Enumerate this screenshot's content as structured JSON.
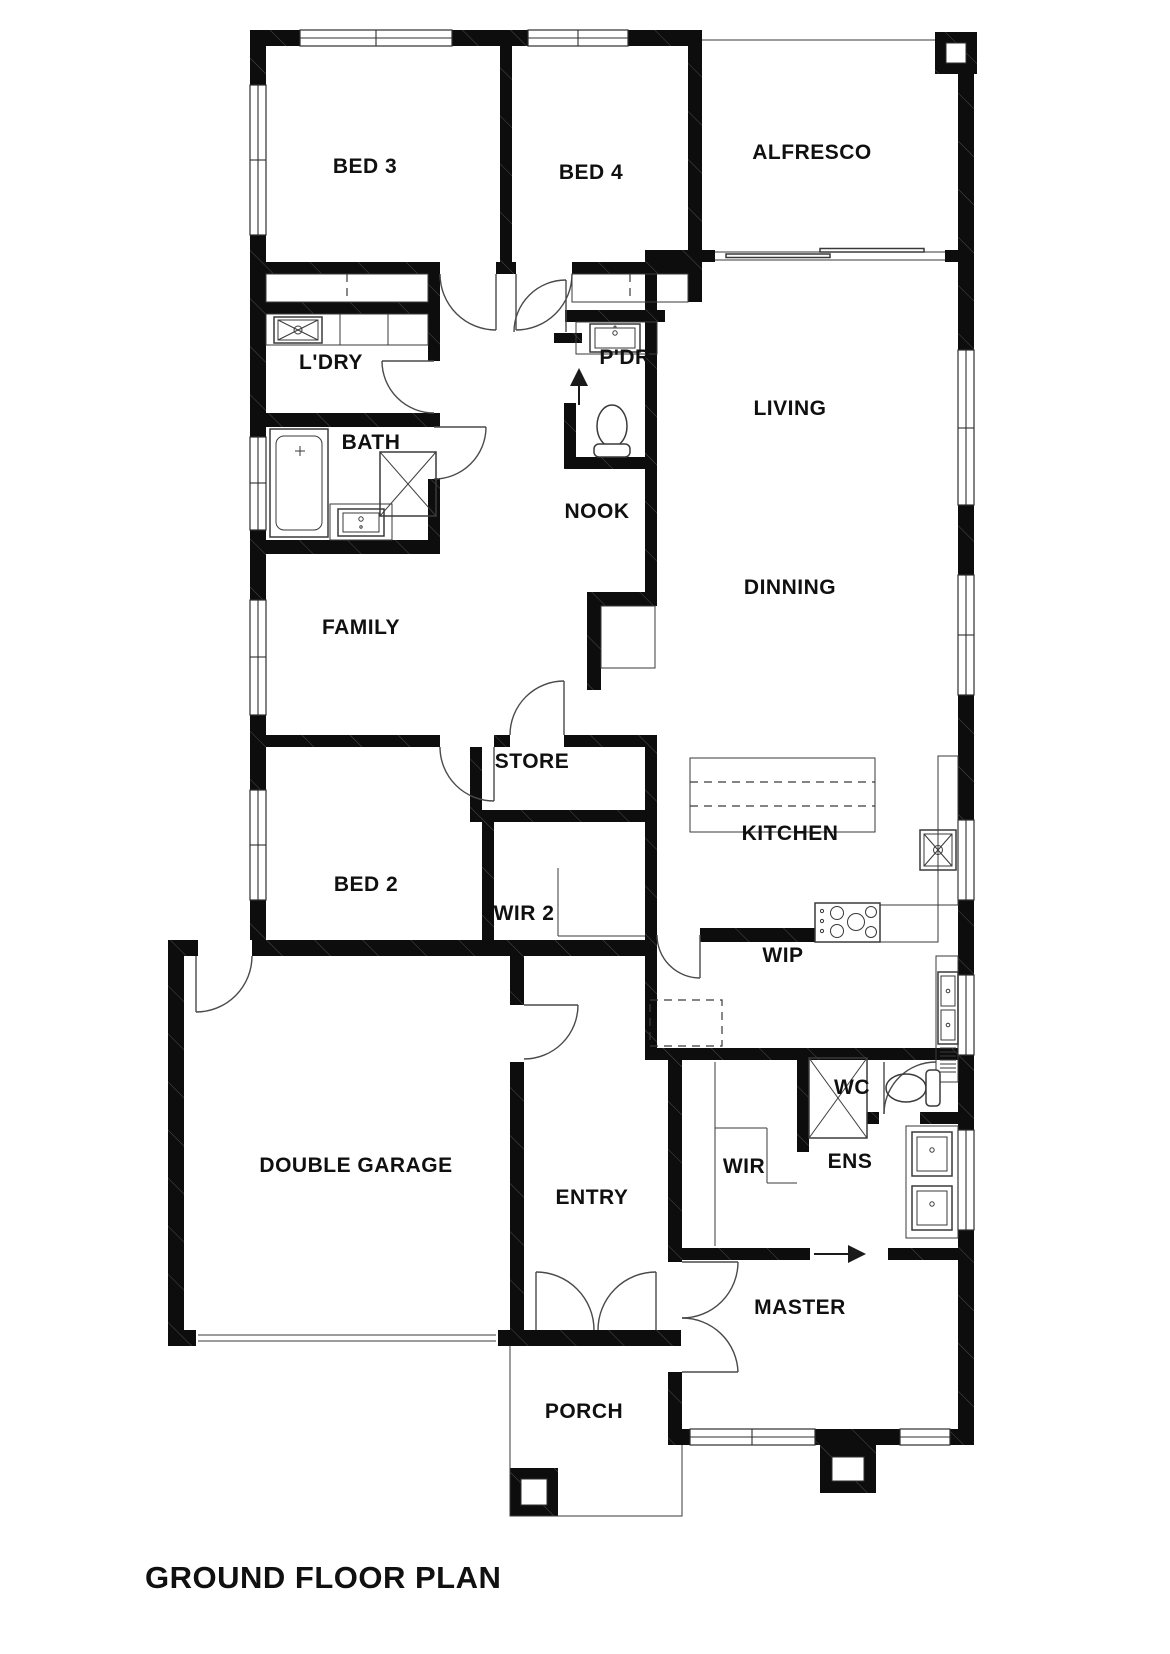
{
  "title": "GROUND FLOOR PLAN",
  "rooms": {
    "bed3": "BED 3",
    "bed4": "BED 4",
    "alfresco": "ALFRESCO",
    "ldry": "L'DRY",
    "pdr": "P'DR",
    "living": "LIVING",
    "bath": "BATH",
    "nook": "NOOK",
    "dinning": "DINNING",
    "family": "FAMILY",
    "store": "STORE",
    "kitchen": "KITCHEN",
    "bed2": "BED 2",
    "wir2": "WIR 2",
    "wip": "WIP",
    "wc": "WC",
    "wir": "WIR",
    "ens": "ENS",
    "garage": "DOUBLE GARAGE",
    "entry": "ENTRY",
    "master": "MASTER",
    "porch": "PORCH"
  },
  "colors": {
    "wall": "#0d0d0d",
    "line": "#3a3a3a",
    "background": "#ffffff"
  }
}
